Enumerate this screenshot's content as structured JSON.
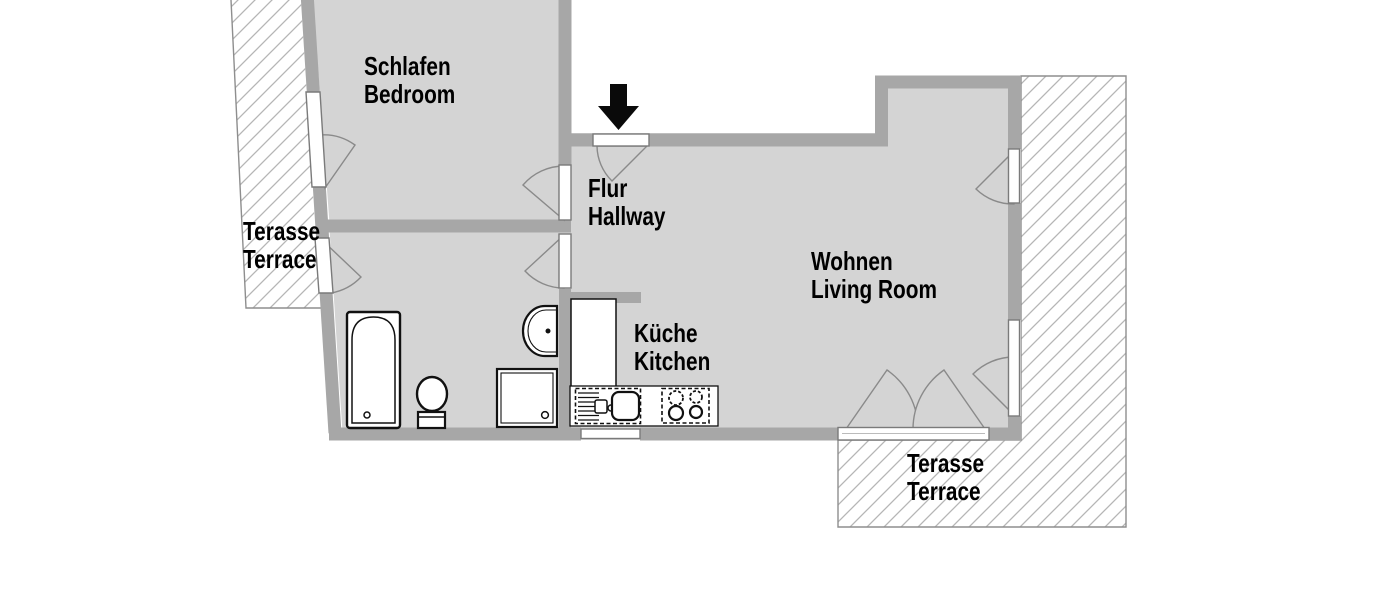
{
  "plan": {
    "type": "apartment-floor-plan",
    "rooms": {
      "bedroom": {
        "de": "Schlafen",
        "en": "Bedroom"
      },
      "hallway": {
        "de": "Flur",
        "en": "Hallway"
      },
      "living_room": {
        "de": "Wohnen",
        "en": "Living Room"
      },
      "kitchen": {
        "de": "Küche",
        "en": "Kitchen"
      },
      "terrace_left": {
        "de": "Terasse",
        "en": "Terrace"
      },
      "terrace_right": {
        "de": "Terasse",
        "en": "Terrace"
      }
    },
    "fixtures": [
      "bathtub",
      "toilet",
      "shower",
      "washbasin",
      "refrigerator",
      "kitchen-sink",
      "stove"
    ],
    "entrance": {
      "marker": "down-arrow"
    },
    "colors": {
      "background": "#ffffff",
      "floor": "#d4d4d4",
      "wall": "#a7a7a7",
      "hatch_line": "#b5b5b5",
      "terrace_border": "#8e8e8e",
      "door_leaf_stroke": "#7a7a7a",
      "swing_stroke": "#8a8a8a",
      "fixture_outline": "#111111",
      "label_text": "#000000",
      "arrow": "#0a0a0a"
    }
  }
}
